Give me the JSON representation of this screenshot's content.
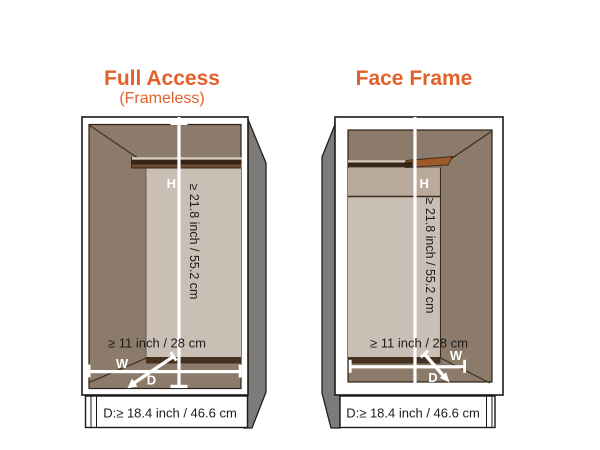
{
  "titles": {
    "left": "Full Access",
    "left_subtitle": "(Frameless)",
    "right": "Face Frame"
  },
  "dimensions": {
    "height_label": "H",
    "width_label": "W",
    "depth_label": "D",
    "height_value": "≥ 21.8 inch / 55.2 cm",
    "width_value": "≥ 11 inch / 28 cm",
    "depth_value": "D:≥ 18.4 inch / 46.6 cm"
  },
  "colors": {
    "background": "#FFFFFF",
    "accent_orange": "#E2612B",
    "cabinet_wall": "#8C7A6A",
    "back_panel": "#C9BFB4",
    "face_frame_rail": "#BAAA9B",
    "floor_shadow": "#45311F",
    "shelf_top_light": "#D8CEC3",
    "shelf_edge_dark": "#352517",
    "shelf_edge_warm": "#6E4A30",
    "shelf_wedge": "#9C5B28",
    "side_panel_gray": "#7C7B79",
    "front_frame_white": "#FFFFFF",
    "dimension_line": "#FFFFFF",
    "text_black": "#1C1C1C"
  }
}
